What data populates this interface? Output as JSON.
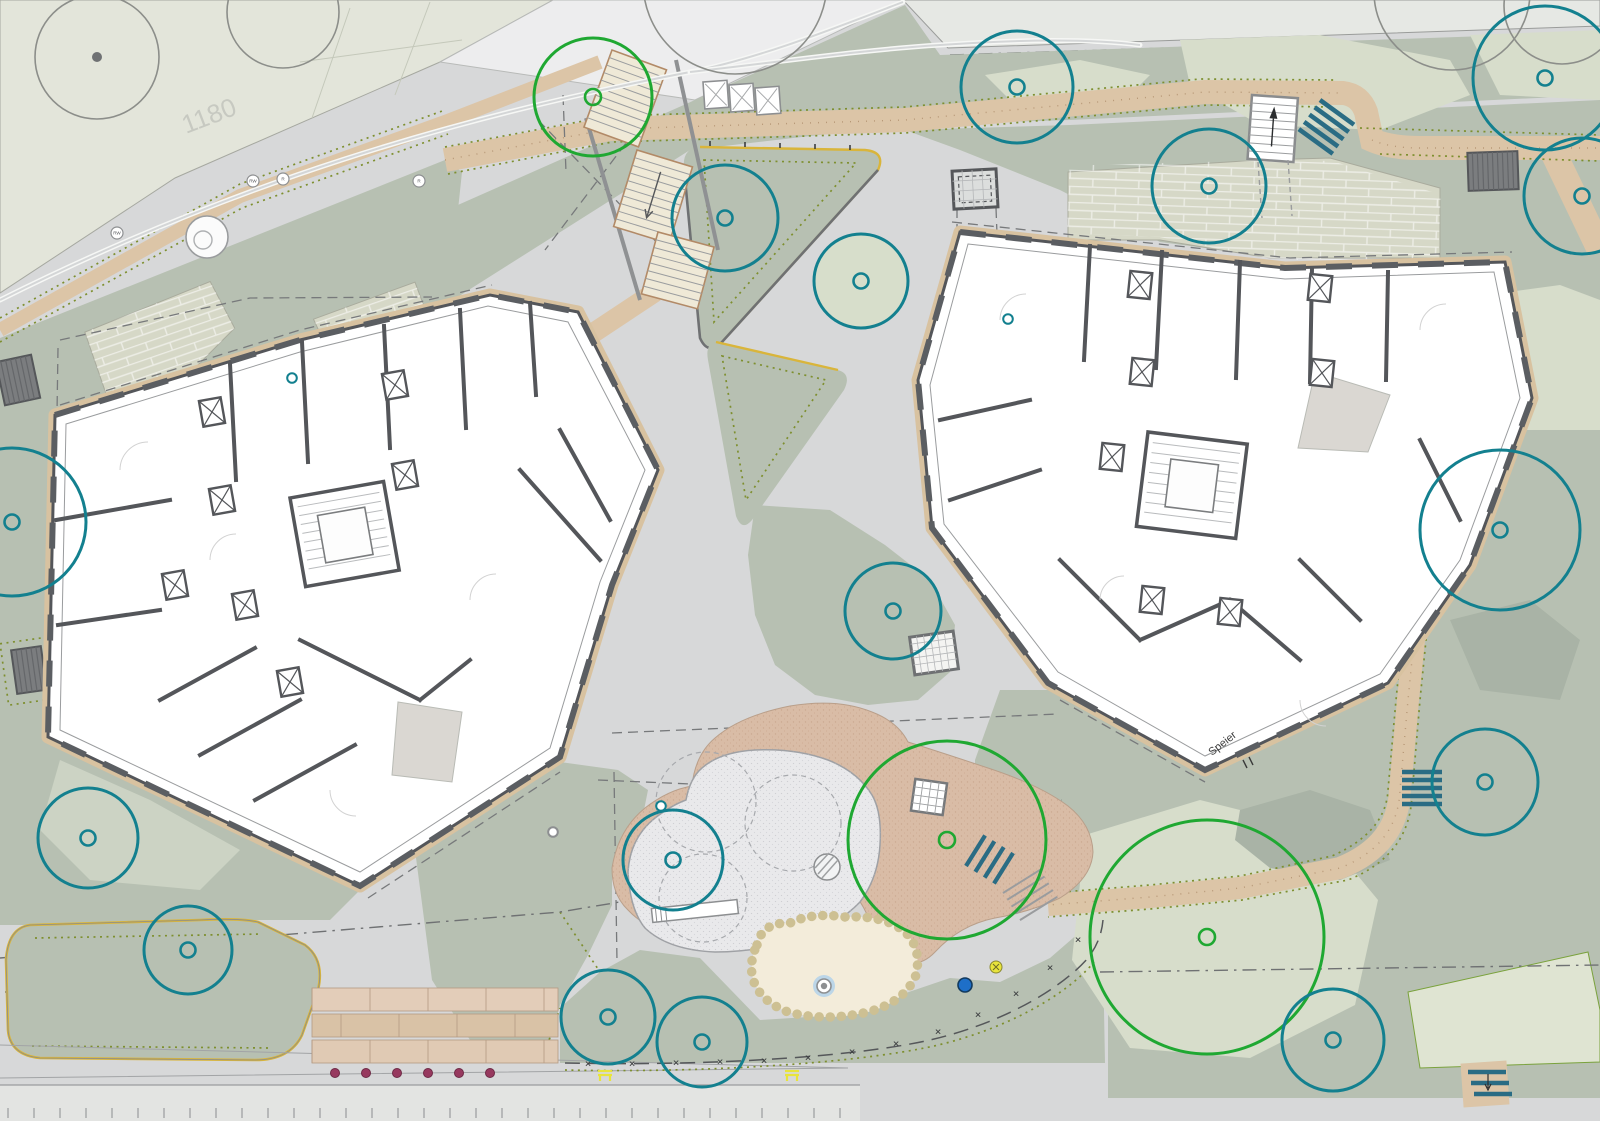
{
  "scene": {
    "width": 1600,
    "height": 1121,
    "title": "Landscape architecture site plan — two residential buildings with courtyard playground"
  },
  "labels": {
    "street_number": "1180",
    "water_spout": "Speier"
  },
  "palette": {
    "plaza_gray": "#d7d8d9",
    "field_green": "#e3e5da",
    "sage_green": "#b7c0b2",
    "lawn_light": "#d7ddcb",
    "gravel_tan": "#dcc5a7",
    "paver": "#d6d8c7",
    "salmon_paving": "#d9bca6",
    "soft_surface": "#e9e9eb",
    "sand": "#f3ecda",
    "building_wall": "#54565a",
    "tree_teal": "#13808f",
    "tree_green": "#1fa832",
    "tree_existing": "#8c8e8a",
    "curb_yellow": "#d9b53b",
    "border_olive": "#7e8f2f",
    "steps_teal": "#2a6c84",
    "bollard_purple": "#97395f",
    "marker_blue": "#1e6fc8",
    "marker_yellow": "#e8e43c"
  },
  "trees": {
    "teal": [
      {
        "cx": 12,
        "cy": 522,
        "r": 74
      },
      {
        "cx": 88,
        "cy": 838,
        "r": 50
      },
      {
        "cx": 188,
        "cy": 950,
        "r": 44
      },
      {
        "cx": 608,
        "cy": 1017,
        "r": 47
      },
      {
        "cx": 702,
        "cy": 1042,
        "r": 45
      },
      {
        "cx": 673,
        "cy": 860,
        "r": 50
      },
      {
        "cx": 725,
        "cy": 218,
        "r": 53
      },
      {
        "cx": 861,
        "cy": 281,
        "r": 47,
        "fill": true
      },
      {
        "cx": 893,
        "cy": 611,
        "r": 48
      },
      {
        "cx": 1017,
        "cy": 87,
        "r": 56
      },
      {
        "cx": 1209,
        "cy": 186,
        "r": 57
      },
      {
        "cx": 1545,
        "cy": 78,
        "r": 72
      },
      {
        "cx": 1582,
        "cy": 196,
        "r": 58
      },
      {
        "cx": 1500,
        "cy": 530,
        "r": 80
      },
      {
        "cx": 1485,
        "cy": 782,
        "r": 53
      },
      {
        "cx": 1333,
        "cy": 1040,
        "r": 51
      }
    ],
    "green": [
      {
        "cx": 593,
        "cy": 97,
        "r": 59
      },
      {
        "cx": 947,
        "cy": 840,
        "r": 99
      },
      {
        "cx": 1207,
        "cy": 937,
        "r": 117
      }
    ],
    "existing": [
      {
        "cx": 97,
        "cy": 57,
        "r": 62,
        "dot": true
      },
      {
        "cx": 283,
        "cy": 12,
        "r": 56
      },
      {
        "cx": 735,
        "cy": -18,
        "r": 92
      },
      {
        "cx": 1452,
        "cy": -8,
        "r": 78
      },
      {
        "cx": 1562,
        "cy": 6,
        "r": 58
      }
    ]
  },
  "utility_markers": [
    {
      "x": 117,
      "y": 233,
      "label": "RW"
    },
    {
      "x": 253,
      "y": 181,
      "label": "RW"
    },
    {
      "x": 283,
      "y": 179,
      "label": "R"
    },
    {
      "x": 419,
      "y": 181,
      "label": "R"
    }
  ],
  "bollards": {
    "x_start": 335,
    "y": 1073,
    "spacing": 31,
    "count": 6,
    "radius": 4.5
  },
  "bike_lockers": [
    {
      "x": 703,
      "y": 82
    },
    {
      "x": 729,
      "y": 85
    },
    {
      "x": 755,
      "y": 88
    }
  ],
  "elevator_shafts": {
    "west": [
      [
        212,
        412
      ],
      [
        222,
        500
      ],
      [
        395,
        385
      ],
      [
        405,
        475
      ],
      [
        175,
        585
      ],
      [
        245,
        605
      ],
      [
        290,
        682
      ]
    ],
    "east": [
      [
        1140,
        285
      ],
      [
        1142,
        372
      ],
      [
        1320,
        288
      ],
      [
        1322,
        373
      ],
      [
        1112,
        457
      ],
      [
        1152,
        600
      ],
      [
        1230,
        612
      ]
    ]
  },
  "fence_marks": [
    [
      588,
      1064
    ],
    [
      632,
      1064
    ],
    [
      676,
      1063
    ],
    [
      720,
      1062
    ],
    [
      764,
      1061
    ],
    [
      808,
      1058
    ],
    [
      852,
      1052
    ],
    [
      896,
      1044
    ],
    [
      938,
      1032
    ],
    [
      978,
      1015
    ],
    [
      1016,
      994
    ],
    [
      1050,
      968
    ],
    [
      1078,
      940
    ]
  ],
  "plank_paving": {
    "x": 312,
    "y": 988,
    "width": 246,
    "rows": 3,
    "row_h": 26,
    "colors": [
      "#e3cdb9",
      "#d9c2a6",
      "#e0cab4"
    ],
    "joint_every": 58
  },
  "sidewalk_ticks": {
    "x_start": 8,
    "y": 1108,
    "spacing": 26,
    "count": 33,
    "len": 10
  },
  "point_markers": {
    "blue_dot": {
      "x": 965,
      "y": 985,
      "r": 7
    },
    "yellow_dot": {
      "x": 996,
      "y": 967,
      "r": 6
    },
    "yellow_benches": [
      [
        605,
        1075
      ],
      [
        792,
        1075
      ]
    ],
    "drains": [
      {
        "x": 553,
        "y": 832,
        "type": "gray"
      },
      {
        "x": 661,
        "y": 806,
        "type": "teal"
      },
      {
        "x": 292,
        "y": 378,
        "type": "teal"
      },
      {
        "x": 1008,
        "y": 319,
        "type": "teal"
      }
    ],
    "manhole": {
      "x": 207,
      "y": 237,
      "r": 21
    }
  }
}
